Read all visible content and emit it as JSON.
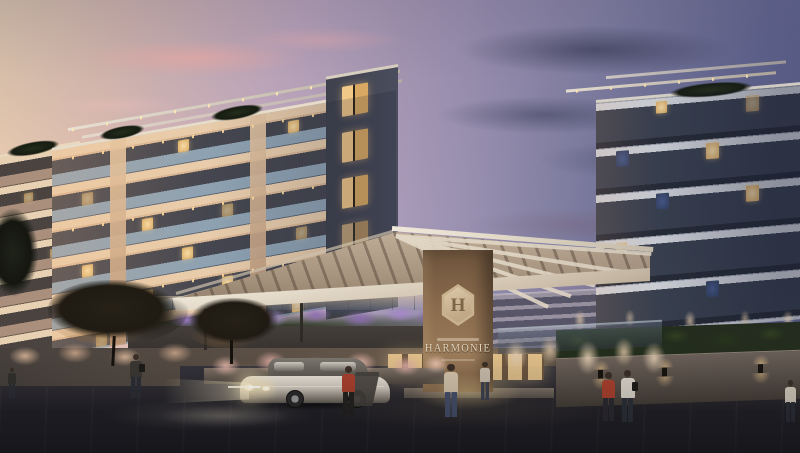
{
  "scene": {
    "description": "Dusk architectural rendering of a residential condominium entrance: two modern apartment towers with lit balconies, an angled entrance canopy on a wooden sign pillar, landscaped planters with lavender and pampas grass, a silver sedan with headlights on, and pedestrians walking on the street.",
    "sign": {
      "monogram": "H",
      "name": "HARMONIE"
    }
  },
  "colors": {
    "sky-warm": "#f6d9b2",
    "sky-cool": "#4d5379",
    "facade-dark": "#45464f",
    "slab-warm": "#e8ccab",
    "glass-balustrade": "#8ea2b2",
    "facade-right": "#39404e",
    "slab-white": "#d2d5da",
    "window-warm": "#f2cf96",
    "window-cool": "#33405e",
    "canopy-light": "#efe8da",
    "canopy-soffit": "#a8957f",
    "wood-dark": "#6d543c",
    "wood-light": "#9a7b59",
    "sign-text": "#e2d2b8",
    "lavender": "#8f6fb0",
    "grass-pink": "#e0b3a6",
    "pampas": "#d8c3a8",
    "hedge": "#232d1c",
    "wall": "#6b6058",
    "street": "#1e1d23",
    "asphalt-light": "#2e2c31",
    "sidewalk-warm": "#6a5a4c",
    "headlight": "#fff3cf",
    "car-silver": "#cfc7bd",
    "glass-car": "#55504a",
    "shirt-red": "#a8402e",
    "shirt-beige": "#cfc0a8",
    "shirt-white": "#d8d2c8",
    "pants-dark": "#2c2e36",
    "skin": "#3a2e26",
    "tree": "#1f1b13"
  }
}
